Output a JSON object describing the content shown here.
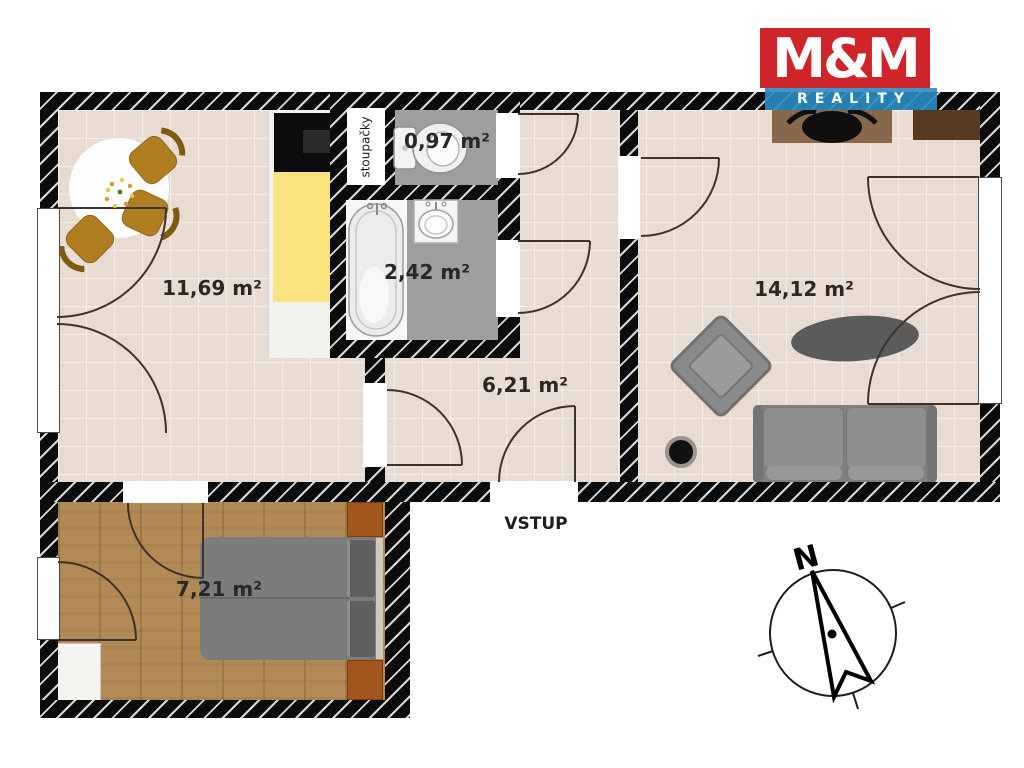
{
  "brand": {
    "name_top": "M&M",
    "name_bottom": "REALITY",
    "red": "#d0242b",
    "blue": "#2a8cc3"
  },
  "rooms": {
    "kitchen_living": {
      "label": "11,69 m²"
    },
    "wc": {
      "label": "0,97 m²"
    },
    "bathroom": {
      "label": "2,42 m²"
    },
    "hallway": {
      "label": "6,21 m²"
    },
    "living_room": {
      "label": "14,12 m²"
    },
    "bedroom": {
      "label": "7,21 m²"
    }
  },
  "annotations": {
    "entrance_label": "VSTUP",
    "riser_shaft_label": "stoupačky",
    "compass_north_label": "N"
  },
  "colors": {
    "wall_black": "#0c0c0c",
    "floor_tile_beige": "#e8dcd2",
    "floor_wet_gray": "#9e9e9e",
    "floor_wood_brown": "#b28a55",
    "counter_yellow": "#f8e37f",
    "chair_brown": "#b07d20",
    "furniture_gray": "#8a8a8a",
    "nightstand_brown": "#a2561b"
  }
}
